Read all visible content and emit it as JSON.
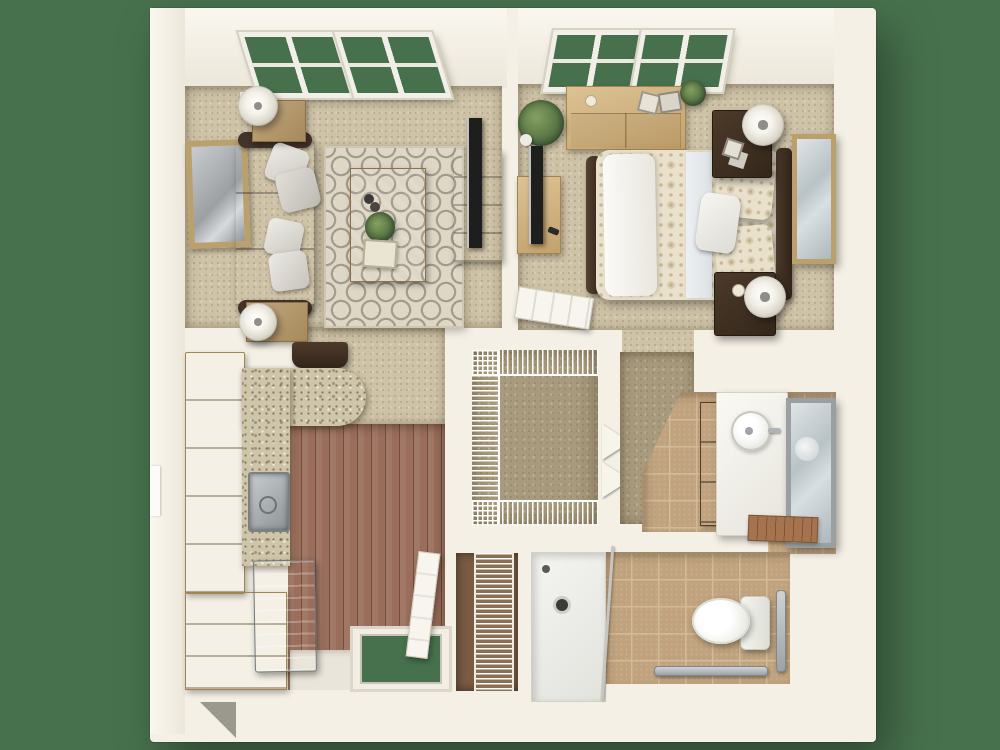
{
  "scene": {
    "description": "3D top-down floor plan rendering of a one-bedroom, one-bathroom apartment",
    "view": "3d-top-down-cutaway",
    "background_color": "#47714D"
  },
  "palette": {
    "background": "#47714D",
    "glass": "#47714D",
    "wall": "#F4F0E6",
    "carpet": "#CFC3A7",
    "carpet_dark": "#A89A7C",
    "wood_floor": "#9A6E5B",
    "tile": "#C0A37E",
    "tile_grout": "#D2BB97",
    "granite": "#CFC5A9",
    "rug_base": "#DED7C6",
    "rug_pattern": "#A39B8C",
    "duvet": "#E9E1CC",
    "tv_black": "#1E1E1C",
    "gold_frame": "#B9A06C"
  },
  "rooms": {
    "living_room": {
      "label": "Living room",
      "objects": [
        "two windows",
        "sofa with four pillows",
        "two end tables with white drum lamps",
        "patterned area rug",
        "coffee table with plant and tray",
        "tv console with flat tv",
        "framed wall art",
        "dark bench"
      ]
    },
    "bedroom": {
      "label": "Bedroom",
      "objects": [
        "two windows",
        "dresser desk with frames and candle",
        "potted plant",
        "tv stand with flat tv",
        "bed with patterned duvet and pillows",
        "two dark nightstands with lamps",
        "gold framed wall mirror",
        "open paneled door"
      ]
    },
    "kitchen": {
      "label": "Kitchen",
      "objects": [
        "tall wood cabinets",
        "granite l-shaped counter with rounded peninsula",
        "stainless sink",
        "stainless refrigerator",
        "base cabinets",
        "plank wood floor"
      ]
    },
    "entry": {
      "label": "Entry",
      "objects": [
        "open entry door",
        "door threshold"
      ]
    },
    "walk_in_closet": {
      "label": "Walk-in closet",
      "objects": [
        "wire shelving on three walls",
        "bifold doors"
      ]
    },
    "hallway": {
      "label": "Hallway",
      "objects": [
        "carpet passage"
      ]
    },
    "bathroom_vanity": {
      "label": "Bathroom vanity area",
      "objects": [
        "white vanity counter with round sink",
        "framed mirror",
        "vanity cabinet",
        "wood bath mat",
        "tile floor"
      ]
    },
    "bathroom": {
      "label": "Bathroom",
      "objects": [
        "roll-in shower with drain and rod",
        "toilet",
        "two grab bars",
        "tile floor"
      ]
    },
    "linen_closet": {
      "label": "Linen closet",
      "objects": [
        "stacked wire shelves"
      ]
    }
  }
}
